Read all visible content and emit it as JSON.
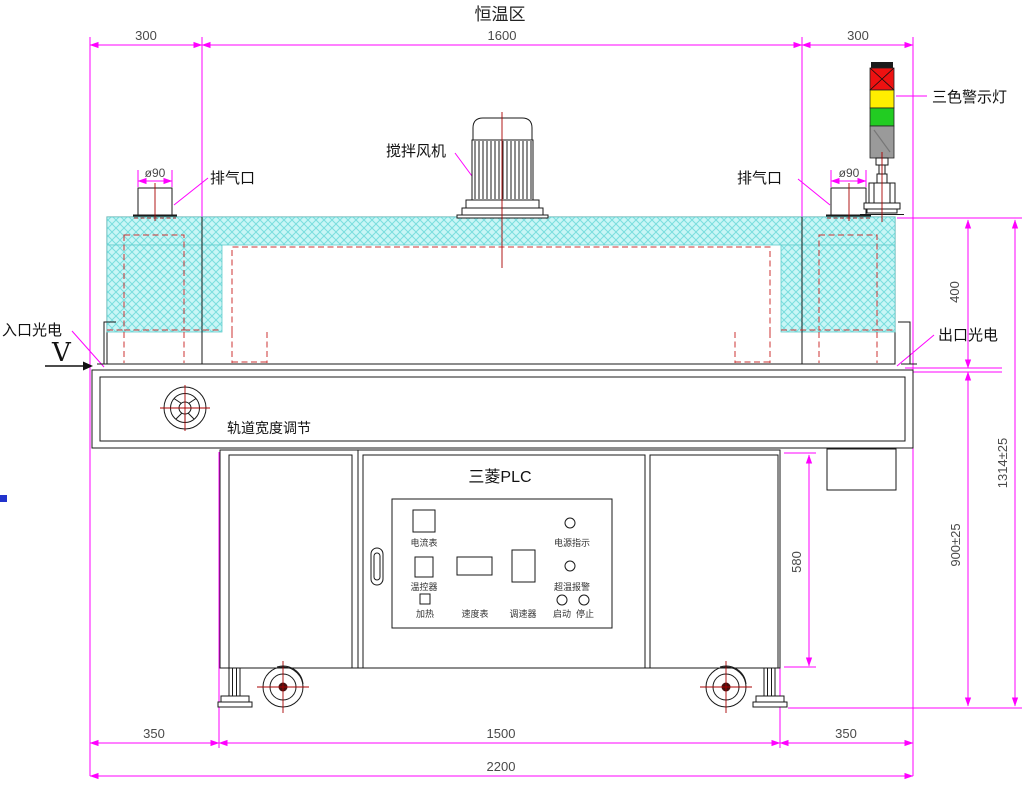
{
  "title": "恒温区",
  "labels": {
    "stir_fan": "搅拌风机",
    "exhaust_left": "排气口",
    "exhaust_right": "排气口",
    "warning_light": "三色警示灯",
    "inlet_sensor": "入口光电",
    "outlet_sensor": "出口光电",
    "direction_mark": "V",
    "track_adjust": "轨道宽度调节"
  },
  "panel": {
    "plc_title": "三菱PLC",
    "ammeter": "电流表",
    "power_indicator": "电源指示",
    "temp_controller": "温控器",
    "overtemp_alarm": "超温报警",
    "heating": "加热",
    "speed_meter": "速度表",
    "speed_regulator": "调速器",
    "start": "启动",
    "stop": "停止"
  },
  "dims": {
    "zone_left": "300",
    "zone_mid": "1600",
    "zone_right": "300",
    "dia_left": "ø90",
    "dia_right": "ø90",
    "oven_height": "400",
    "total_height": "1314±25",
    "belt_height": "900±25",
    "cabinet_height": "580",
    "foot_left": "350",
    "base_mid": "1500",
    "foot_right": "350",
    "total_length": "2200"
  },
  "colors": {
    "lamp_red": "#ee1111",
    "lamp_yellow": "#ffee00",
    "lamp_green": "#22cc22",
    "lamp_gray": "#9a9a9a",
    "dimension_magenta": "#ff00ff",
    "insulation_cyan": "#c9f6f6",
    "hidden_line_red": "#cc3333"
  }
}
